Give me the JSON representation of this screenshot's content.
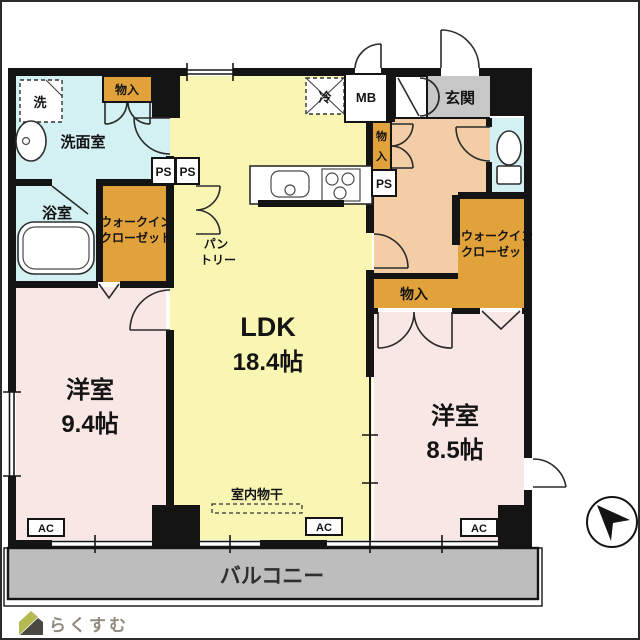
{
  "plan": {
    "ldk": {
      "name": "LDK",
      "size": "18.4帖"
    },
    "bedroom_left": {
      "name": "洋室",
      "size": "9.4帖"
    },
    "bedroom_right": {
      "name": "洋室",
      "size": "8.5帖"
    },
    "washroom": "洗面室",
    "bathroom": "浴室",
    "entrance": "玄関",
    "balcony": "バルコニー",
    "wic": {
      "line1": "ウォークイン",
      "line2": "クローゼット"
    },
    "pantry": {
      "line1": "パン",
      "line2": "トリー"
    },
    "indoor_drying": "室内物干",
    "storage": "物入",
    "storage_vertical": {
      "line1": "物",
      "line2": "入"
    },
    "ps": "PS",
    "mb": "MB",
    "ac": "AC",
    "washer": "洗",
    "fridge": "冷"
  },
  "logo": {
    "text": "らくすむ"
  },
  "colors": {
    "ldk": "#F9F6B4",
    "bedroom": "#F9E7E6",
    "hall": "#F3CDA6",
    "storage": "#E2A23B",
    "wet": "#D3F0F3",
    "entrance": "#C7C7C7",
    "balcony": "#BDBDBD",
    "wall": "#141414"
  }
}
